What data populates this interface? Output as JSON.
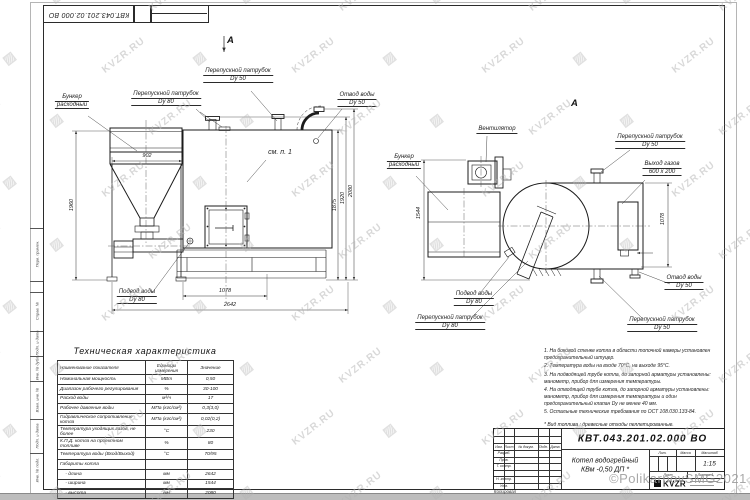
{
  "watermark": {
    "text": "KVZR.RU",
    "copyright": "©PolikarpovSMG2021"
  },
  "margin_labels": [
    "Перв. примен.",
    "Справ. №",
    "Подп. и дата",
    "Инв. № дубл.",
    "Взам. инв. №",
    "Подп. и дата",
    "Инв. № подл."
  ],
  "front_view": {
    "view_arrow_label": "А",
    "hopper_l1": "Бункер",
    "hopper_l2": "расходный",
    "bypass80_l1": "Перепускной патрубок",
    "bypass80_l2": "Dy 80",
    "bypass50_l1": "Перепускной патрубок",
    "bypass50_l2": "Dy 50",
    "outlet_l1": "Отвод воды",
    "outlet_l2": "Dy 50",
    "see_note": "см. п. 1",
    "inlet_l1": "Подвод воды",
    "inlet_l2": "Dy 80",
    "dim_hopper_width": "902",
    "dim_height": "1960",
    "dim_1078": "1078",
    "dim_length": "2642",
    "dim_h1": "1875",
    "dim_h2": "1920",
    "dim_h3": "2080"
  },
  "top_view": {
    "view_label": "А",
    "fan_label": "Вентилятор",
    "hopper_l1": "Бункер",
    "hopper_l2": "расходный",
    "bypass50_top_l1": "Перепускной патрубок",
    "bypass50_top_l2": "Dy 50",
    "gas_l1": "Выход газов",
    "gas_l2": "600 х 200",
    "inlet_l1": "Подвод воды",
    "inlet_l2": "Dy 80",
    "bypass80_l1": "Перепускной патрубок",
    "bypass80_l2": "Dy 80",
    "bypass50_bot_l1": "Перепускной патрубок",
    "bypass50_bot_l2": "Dy 50",
    "outlet_l1": "Отвод воды",
    "outlet_l2": "Dy 50",
    "dim_width": "1544",
    "dim_1078": "1078"
  },
  "tech_table": {
    "title": "Техническая характеристика",
    "headers": [
      "Наименование показателя",
      "Единицы измерения",
      "Значение"
    ],
    "rows": [
      [
        "Номинальная мощность",
        "МВт",
        "0,50"
      ],
      [
        "Диапазон рабочего регулирования",
        "%",
        "30-100"
      ],
      [
        "Расход воды",
        "м³/ч",
        "17"
      ],
      [
        "Рабочее давление воды",
        "МПа (кгс/см²)",
        "0,3(3,0)"
      ],
      [
        "Гидравлическое сопротивление котла",
        "МПа (кгс/см²)",
        "0,02(0,2)"
      ],
      [
        "Температура уходящих газов, не более",
        "°С",
        "230"
      ],
      [
        "К.П.Д. котла на проектном топливе",
        "%",
        "80"
      ],
      [
        "Температура воды (Вход/Выход)",
        "°С",
        "70/95"
      ],
      [
        "Габариты котла",
        "",
        ""
      ],
      [
        "    - длина",
        "мм",
        "2642"
      ],
      [
        "    - ширина",
        "мм",
        "1544"
      ],
      [
        "    - высота",
        "мм",
        "2080"
      ]
    ]
  },
  "notes": {
    "items": [
      "1.  На боковой стенке котла в области топочной камеры установлен предохранительный штуцер.",
      "2.  Температура воды на входе 70°С, на выходе 95°С.",
      "3.  На подводящей трубе котла, до запорной арматуры установлены: манометр, прибор для измерения температуры.",
      "4.  На отводящей трубе котла, до запорной арматуры установлены: манометр, прибор для измерения температуры и один предохранительный клапан Dy не менее 40 мм.",
      "5.  Остальные технические требования по ОСТ 108.030.133-84."
    ],
    "fuel": "*  Вид топлива : древесные отходы пеллетированные."
  },
  "title_block": {
    "doc_number": "КВТ.043.201.02.000  ВО",
    "name_line1": "Котел водогрейный",
    "name_line2": "КВм -0,50  ДП *",
    "cols": [
      "Изм.",
      "Лист",
      "№ докум.",
      "Подп.",
      "Дата"
    ],
    "row_labels": [
      "Разраб.",
      "Пров.",
      "Т. контр.",
      "Н. контр.",
      "Утв."
    ],
    "lit_label": "Лит.",
    "mass_label": "Масса",
    "scale_label": "Масштаб",
    "scale_value": "1:15",
    "sheet_label": "Лист",
    "sheets_label": "Листов 1",
    "logo_text": "KVZR",
    "copied_label": "Копировал"
  }
}
